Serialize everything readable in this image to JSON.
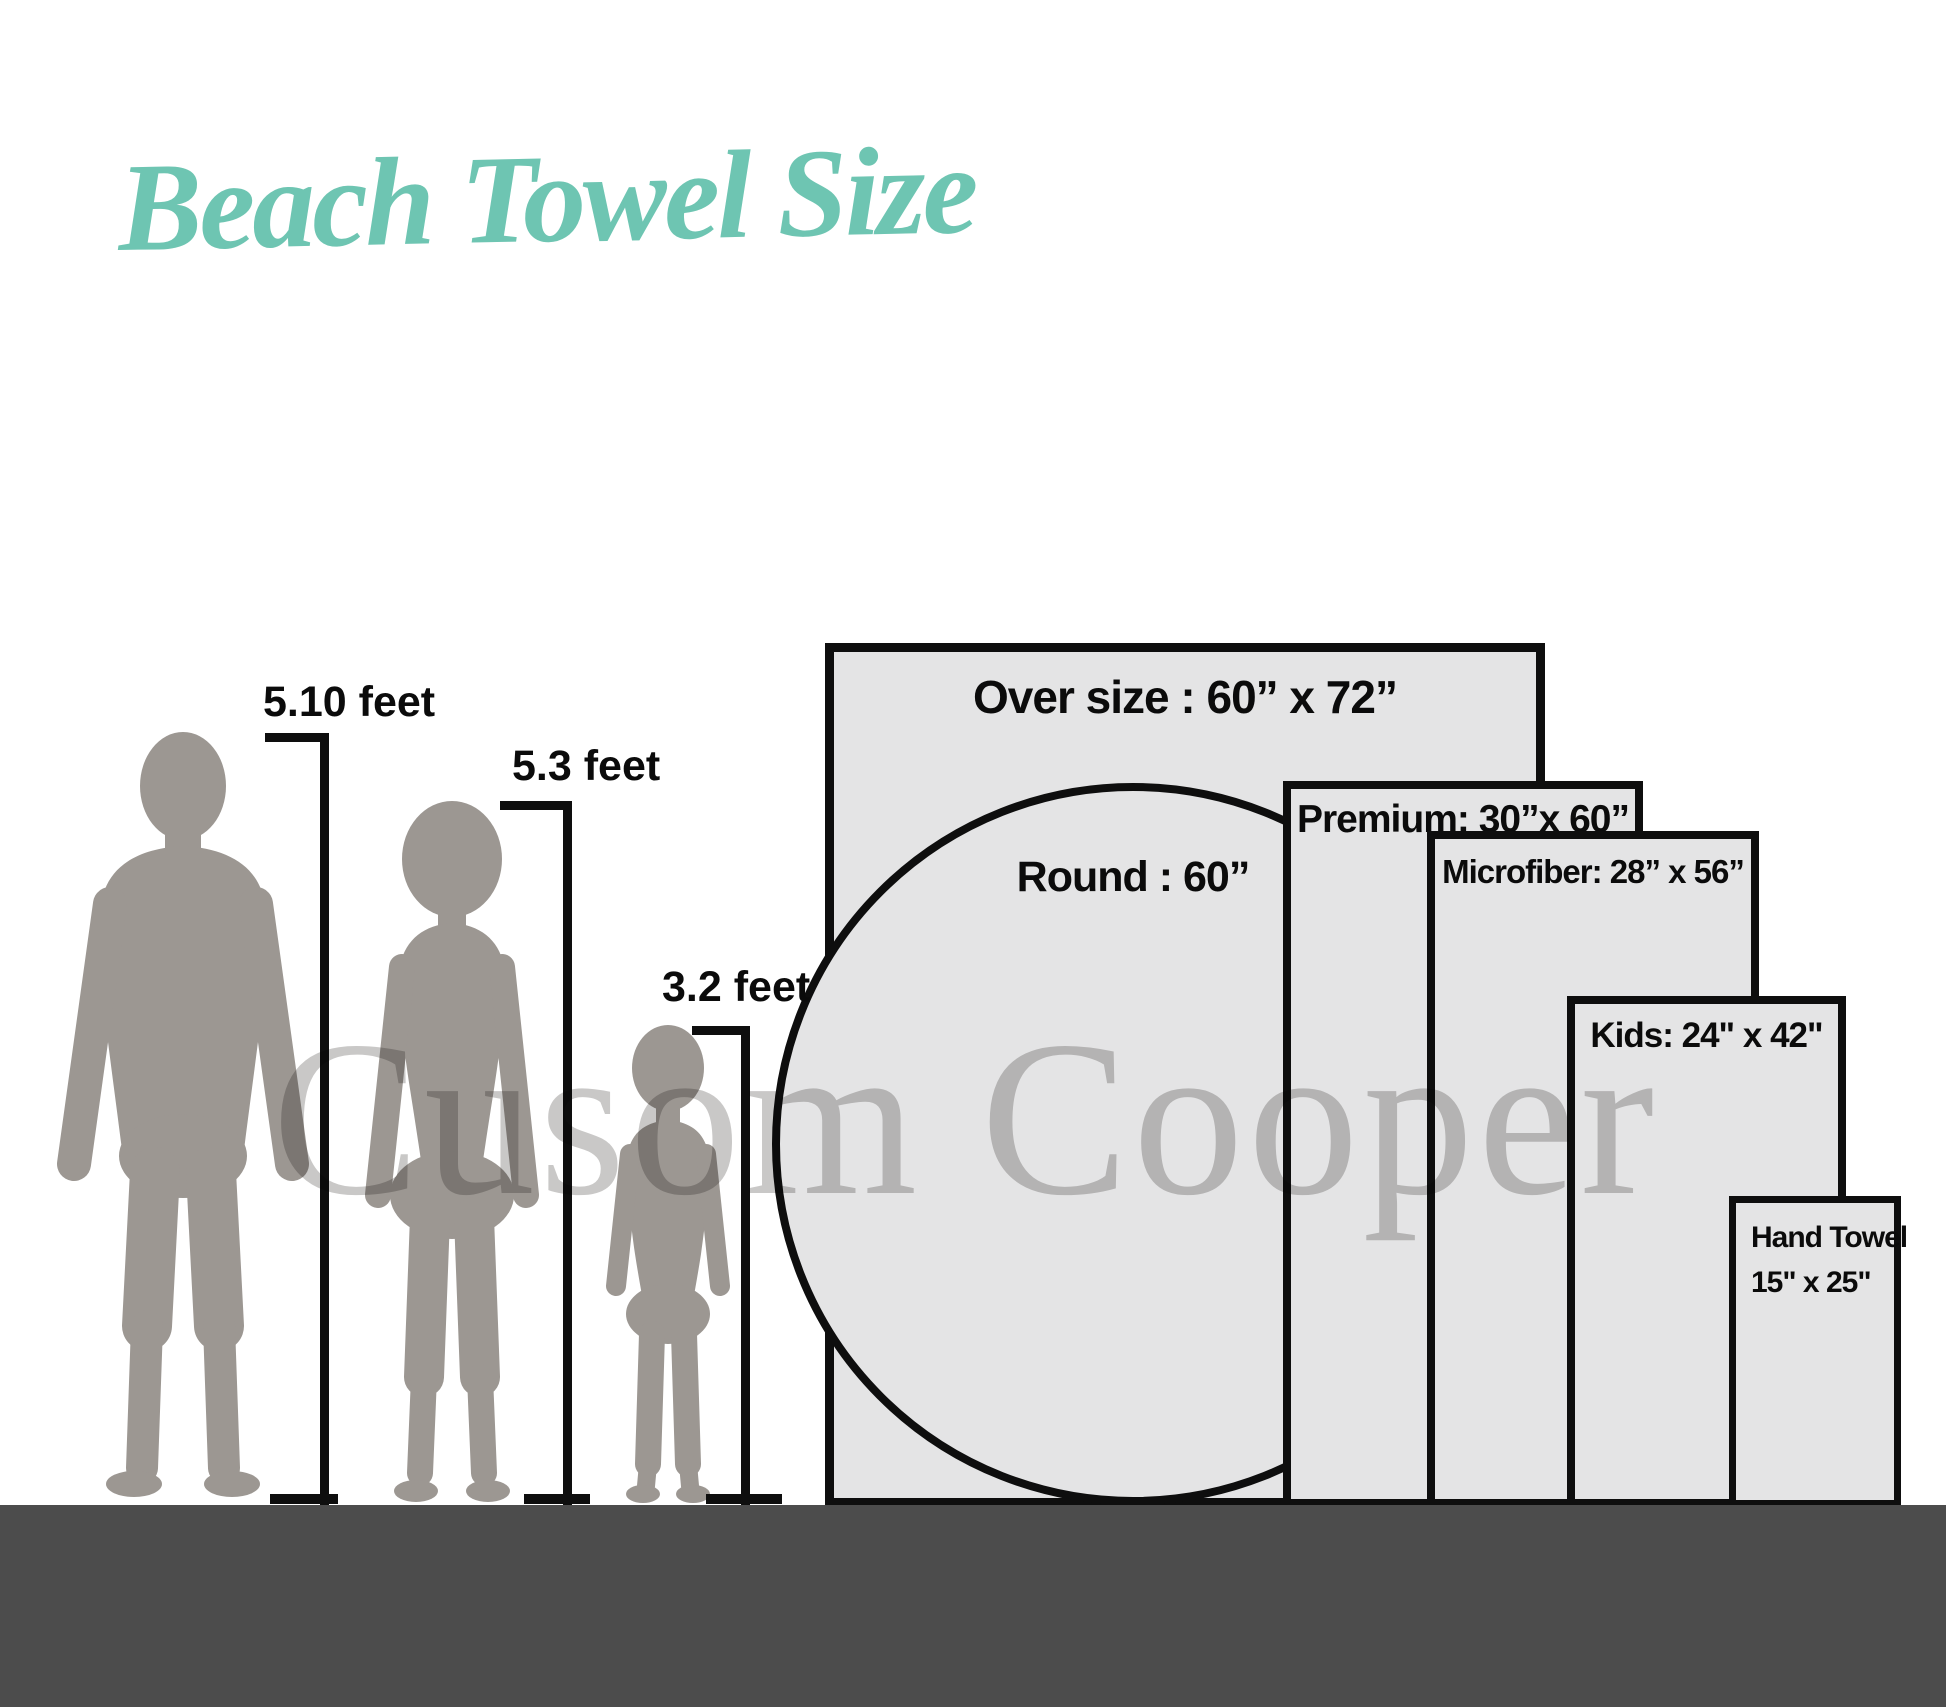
{
  "title": "Beach Towel Size",
  "watermark": "Cusom Cooper",
  "people": [
    {
      "name": "man",
      "height_label": "5.10 feet"
    },
    {
      "name": "woman",
      "height_label": "5.3 feet"
    },
    {
      "name": "child",
      "height_label": "3.2 feet"
    }
  ],
  "towels": {
    "oversize": {
      "label": "Over size  : 60” x 72”"
    },
    "round": {
      "label": "Round  : 60”"
    },
    "premium": {
      "label": "Premium:  30”x 60”"
    },
    "microfiber": {
      "label": "Microfiber: 28” x 56”"
    },
    "kids": {
      "label": "Kids: 24\" x 42\""
    },
    "hand_towel": {
      "label_line1": "Hand Towel",
      "label_line2": "15\" x 25\""
    }
  },
  "colors": {
    "title_teal": "#6ec5b2",
    "towel_fill": "#e4e4e5",
    "outline_black": "#0e0e0e",
    "figure_gray": "#9c9792",
    "ground_gray": "#4c4c4c",
    "watermark_gray": "#c9c8c7"
  }
}
